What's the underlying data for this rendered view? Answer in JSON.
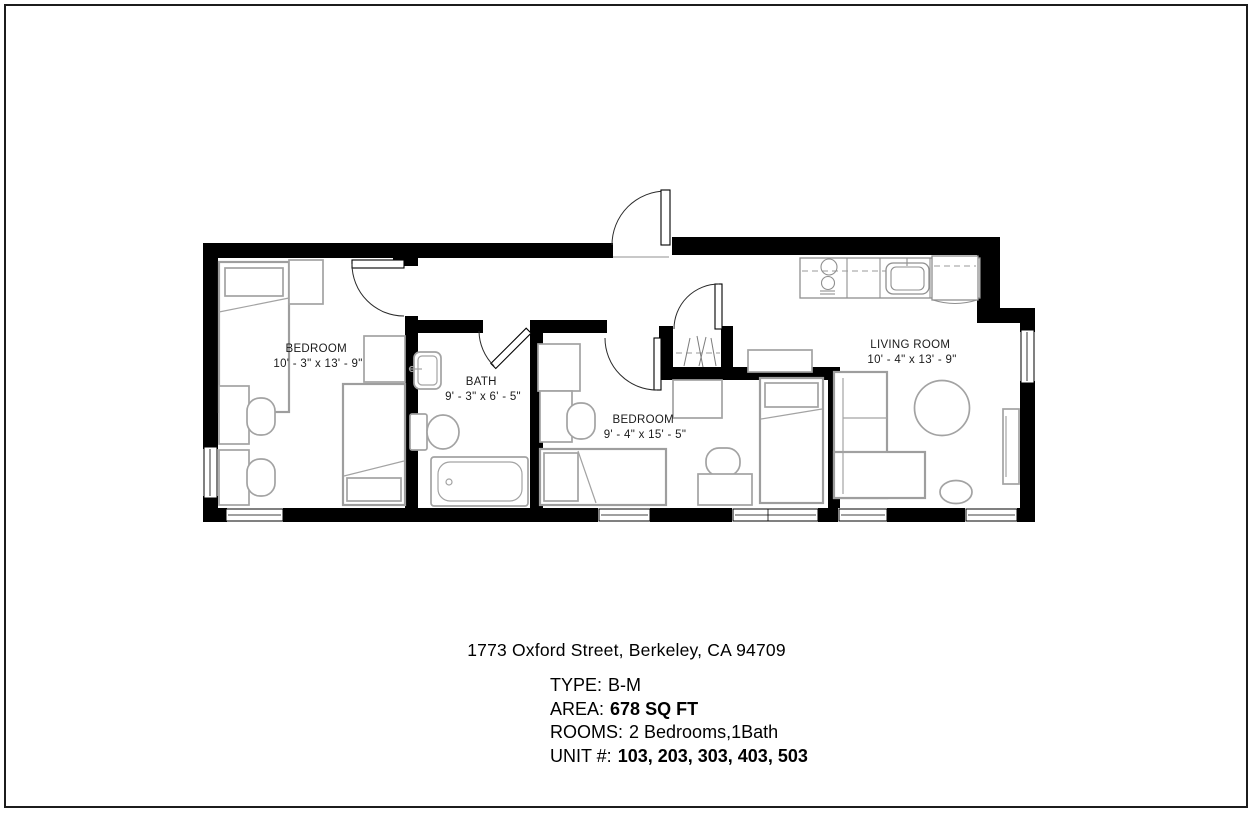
{
  "floor_plan": {
    "wall_color": "#000000",
    "furniture_color": "#a3a3a3",
    "rooms": [
      {
        "name": "BEDROOM",
        "dimensions": "10' - 3\" x 13' - 9\""
      },
      {
        "name": "BATH",
        "dimensions": "9' - 3\" x 6' - 5\""
      },
      {
        "name": "BEDROOM",
        "dimensions": "9' - 4\" x 15' - 5\""
      },
      {
        "name": "LIVING ROOM",
        "dimensions": "10' - 4\" x 13' - 9\""
      }
    ]
  },
  "details": {
    "address": "1773 Oxford Street, Berkeley, CA 94709",
    "type": {
      "label": "TYPE:",
      "value": "B-M"
    },
    "area": {
      "label": "AREA:",
      "value": "678 SQ FT"
    },
    "rooms": {
      "label": "ROOMS:",
      "value": "2 Bedrooms,1Bath"
    },
    "unit": {
      "label": "UNIT #:",
      "value": "103, 203, 303, 403, 503"
    }
  }
}
